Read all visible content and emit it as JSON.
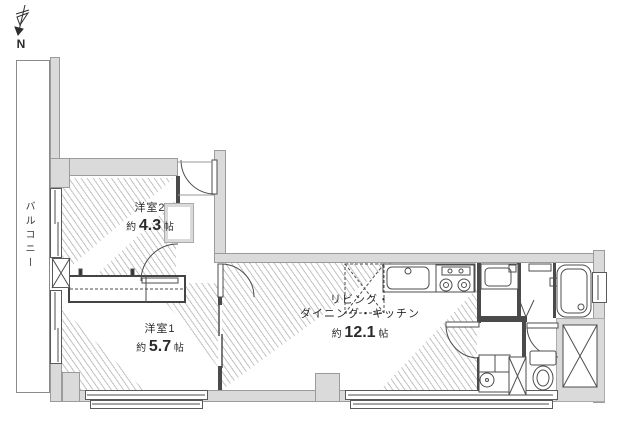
{
  "title": "間取り図",
  "compass": {
    "label": "N"
  },
  "balcony": {
    "label": "バルコニー"
  },
  "rooms": {
    "yoshitsu2": {
      "name": "洋室2",
      "size_prefix": "約",
      "size_value": "4.3",
      "size_unit": "帖"
    },
    "yoshitsu1": {
      "name": "洋室1",
      "size_prefix": "約",
      "size_value": "5.7",
      "size_unit": "帖"
    },
    "ldk": {
      "name_line1": "リビング・",
      "name_line2": "ダイニング・キッチン",
      "size_prefix": "約",
      "size_value": "12.1",
      "size_unit": "帖"
    }
  },
  "colors": {
    "wall_fill": "#dadada",
    "wall_edge": "#9b9b9b",
    "line": "#4a4a4a",
    "background": "#ffffff"
  }
}
